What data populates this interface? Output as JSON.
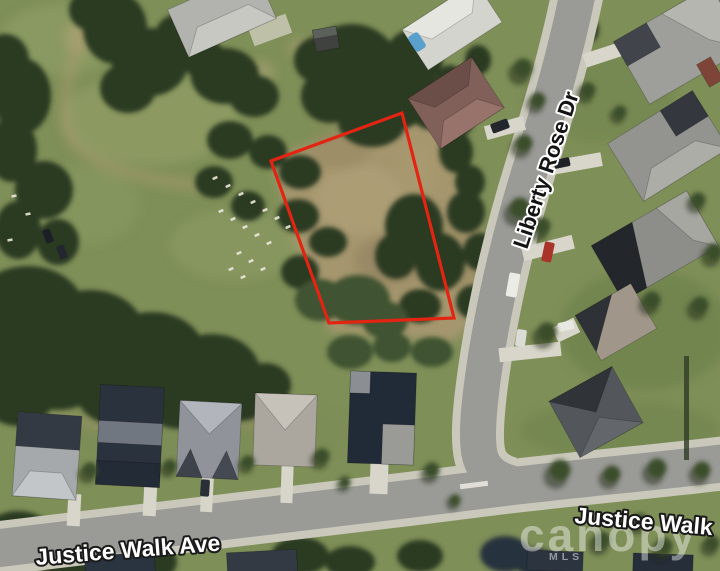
{
  "image_type": "aerial-parcel-photo",
  "streets": {
    "liberty_rose_dr": "Liberty Rose Dr",
    "justice_walk_ave": "Justice Walk Ave",
    "justice_walk": "Justice Walk"
  },
  "watermark": {
    "brand": "canopy",
    "sub": "MLS"
  },
  "parcel": {
    "outline_color": "#e32413"
  }
}
